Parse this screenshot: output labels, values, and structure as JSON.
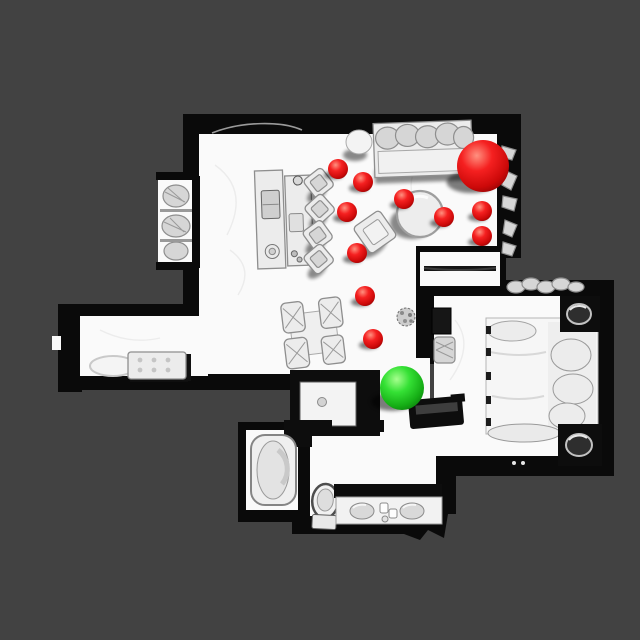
{
  "scene": {
    "description": "top-down orthographic render of a 3D-scanned apartment with sphere markers",
    "canvas": {
      "width": 640,
      "height": 640
    },
    "colors": {
      "background": "#424242",
      "wall": "#0a0a0a",
      "floor": "#fafafa",
      "furniture_light": "#ececec",
      "furniture_mid": "#d6d6d6",
      "furniture_outline": "#8e8e8e"
    },
    "rooms": [
      {
        "name": "living-room"
      },
      {
        "name": "hallway-left"
      },
      {
        "name": "bedroom-right"
      },
      {
        "name": "bathroom-bottom"
      },
      {
        "name": "bathtub-room"
      }
    ],
    "furniture": [
      "sofa",
      "ottoman",
      "desk",
      "desk-chairs",
      "shelf-alcove",
      "round-table",
      "armchair",
      "dining-table-chairs",
      "sideboard",
      "closet-fragments",
      "kitchen-island",
      "dark-bench",
      "hallway-bench",
      "rug",
      "potted-plant",
      "bed",
      "nightstand-top",
      "nightstand-bottom",
      "wall-mirror",
      "laundry-basket",
      "bathtub",
      "toilet",
      "vanity-double-sink"
    ]
  },
  "markers": {
    "red_sphere_color": "#ee1111",
    "green_sphere_color": "#2bd62b",
    "red_gradient": [
      {
        "offset": "0%",
        "color": "#ff9180"
      },
      {
        "offset": "35%",
        "color": "#f52020"
      },
      {
        "offset": "72%",
        "color": "#cc0909"
      },
      {
        "offset": "100%",
        "color": "#7a0202"
      }
    ],
    "green_gradient": [
      {
        "offset": "0%",
        "color": "#a6ff8e"
      },
      {
        "offset": "35%",
        "color": "#35e135"
      },
      {
        "offset": "72%",
        "color": "#15ad15"
      },
      {
        "offset": "100%",
        "color": "#0a6e0a"
      }
    ],
    "red_spheres": [
      {
        "x": 338,
        "y": 169,
        "r": 10
      },
      {
        "x": 363,
        "y": 182,
        "r": 10
      },
      {
        "x": 347,
        "y": 212,
        "r": 10
      },
      {
        "x": 404,
        "y": 199,
        "r": 10
      },
      {
        "x": 444,
        "y": 217,
        "r": 10
      },
      {
        "x": 482,
        "y": 211,
        "r": 10
      },
      {
        "x": 482,
        "y": 236,
        "r": 10
      },
      {
        "x": 357,
        "y": 253,
        "r": 10
      },
      {
        "x": 365,
        "y": 296,
        "r": 10
      },
      {
        "x": 373,
        "y": 339,
        "r": 10
      }
    ],
    "large_red_sphere": {
      "x": 483,
      "y": 166,
      "r": 26
    },
    "green_sphere": {
      "x": 402,
      "y": 388,
      "r": 22
    }
  }
}
